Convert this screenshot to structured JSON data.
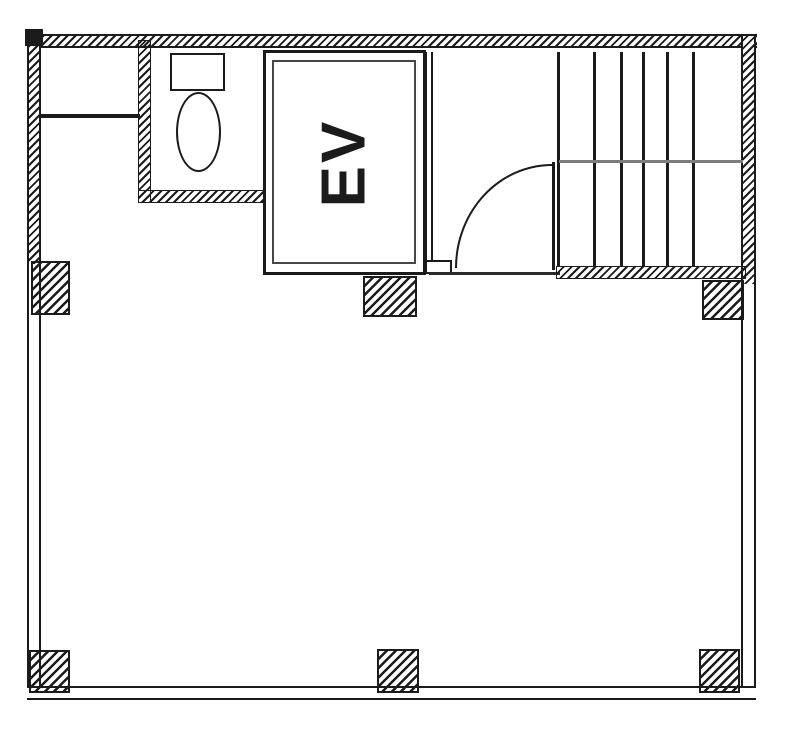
{
  "colors": {
    "ink": "#1b1b1b",
    "paper": "#ffffff",
    "shadow": "#7d7d7d"
  },
  "elevator": {
    "label": "EV"
  },
  "stairs": {
    "tread_x_px": [
      557,
      593,
      620,
      642,
      666,
      692
    ],
    "tread_top_px": 52,
    "tread_height_px": 215
  }
}
